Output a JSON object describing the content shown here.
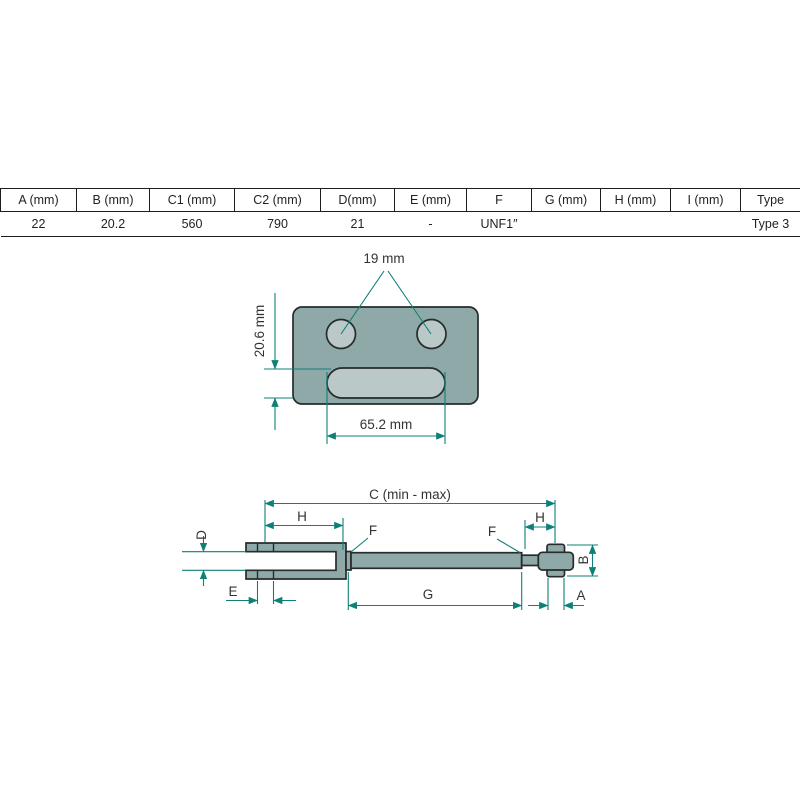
{
  "table": {
    "headers": [
      "A (mm)",
      "B (mm)",
      "C1 (mm)",
      "C2 (mm)",
      "D(mm)",
      "E (mm)",
      "F",
      "G (mm)",
      "H (mm)",
      "I (mm)",
      "Type"
    ],
    "values": [
      "22",
      "20.2",
      "560",
      "790",
      "21",
      "-",
      "UNF1″",
      "",
      "",
      "",
      "Type 3"
    ]
  },
  "plate_drawing": {
    "hole_diameter_label": "19 mm",
    "slot_height_label": "20.6 mm",
    "slot_length_label": "65.2 mm"
  },
  "link_drawing": {
    "overall_length_label": "C (min - max)",
    "fork_length_label": "H",
    "ball_end_length_label": "H",
    "fork_gap_label": "D",
    "pin_hole_label": "E",
    "tube_length_label": "G",
    "ball_width_label": "A",
    "ball_height_label": "B",
    "thread_label_left": "F",
    "thread_label_right": "F"
  },
  "colors": {
    "metal_fill": "#8FA9A9",
    "hole_fill": "#BAC8C8",
    "outline": "#262B2B",
    "dimension": "#0E8076",
    "text": "#333333"
  }
}
